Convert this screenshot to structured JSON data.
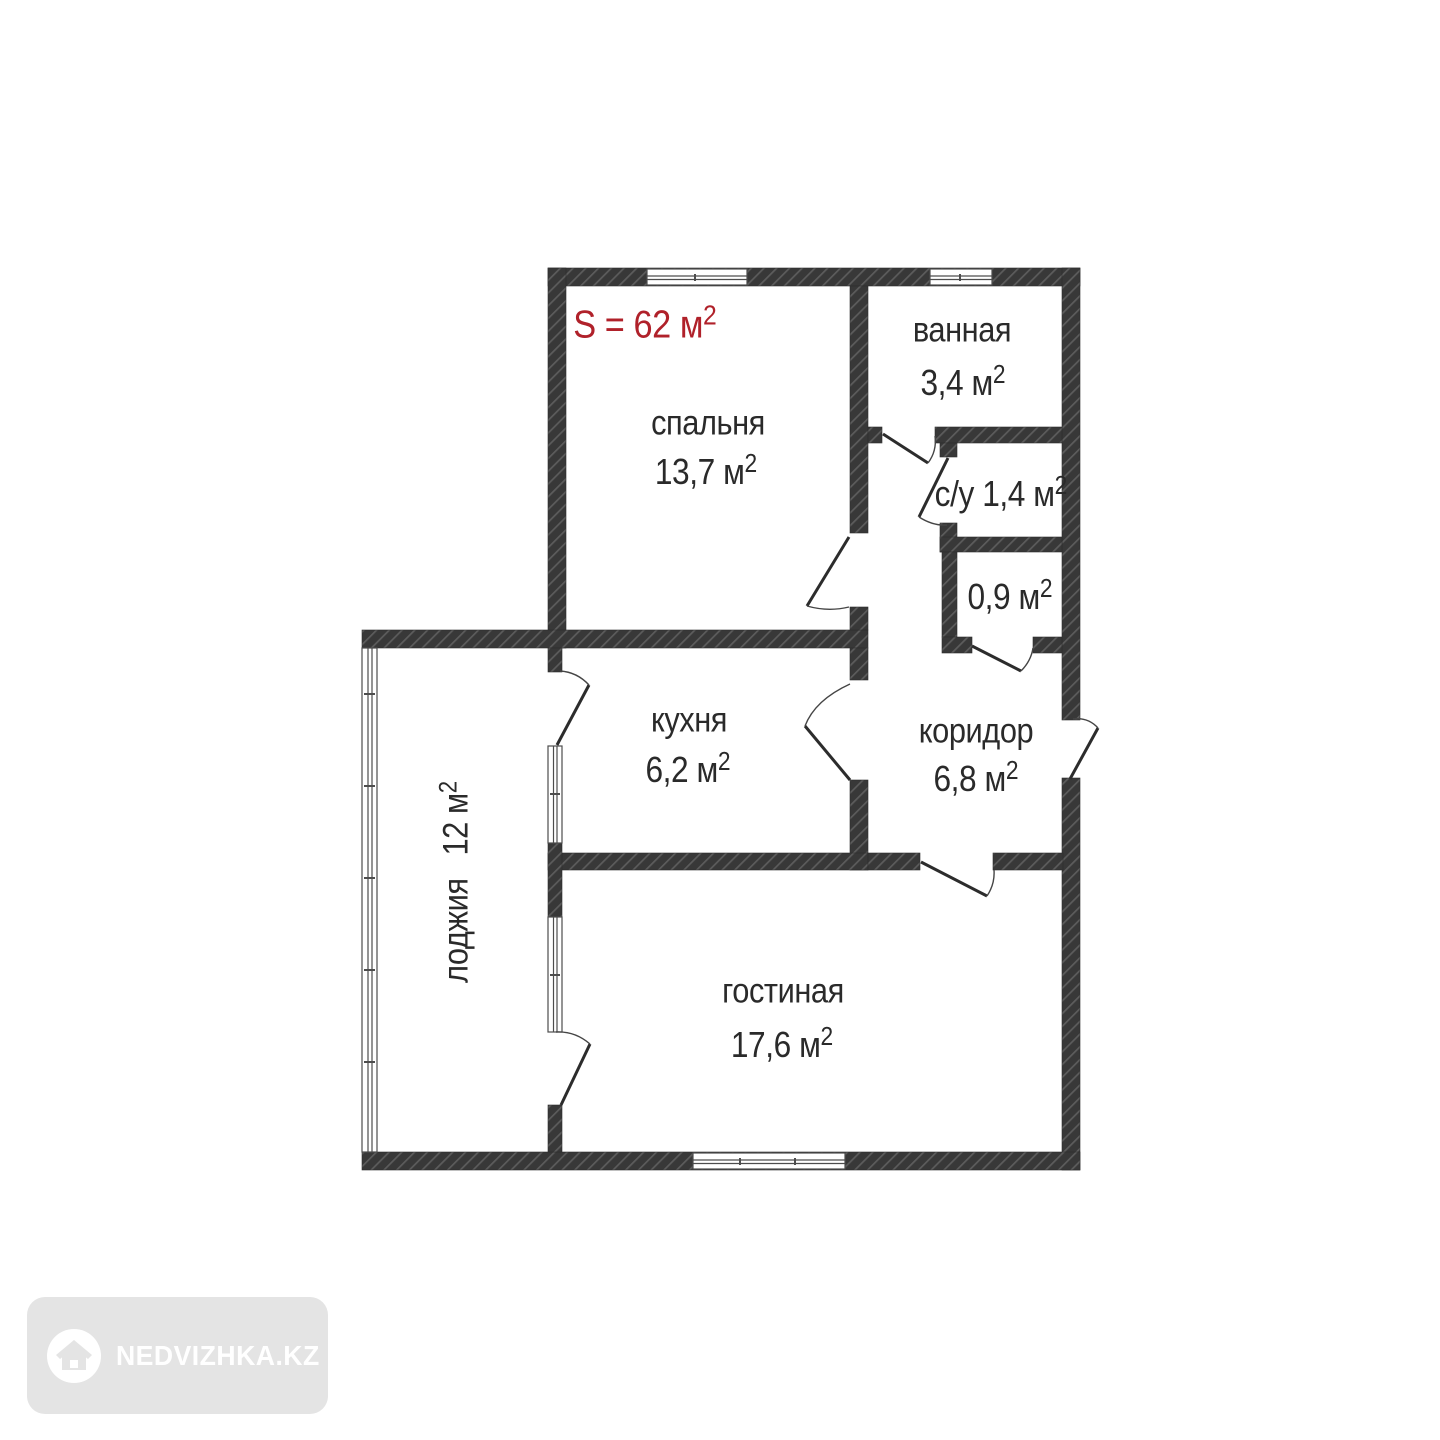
{
  "plan": {
    "total_area": "S = 62 м",
    "sup": "2"
  },
  "rooms": {
    "bedroom": {
      "name": "спальня",
      "area": "13,7 м"
    },
    "bathroom": {
      "name": "ванная",
      "area": "3,4 м"
    },
    "wc": {
      "label": "с/у 1,4 м"
    },
    "storage": {
      "area": "0,9 м"
    },
    "kitchen": {
      "name": "кухня",
      "area": "6,2 м"
    },
    "corridor": {
      "name": "коридор",
      "area": "6,8 м"
    },
    "loggia": {
      "name": "лоджия",
      "area": "12 м"
    },
    "living": {
      "name": "гостиная",
      "area": "17,6 м"
    }
  },
  "watermark": {
    "text": "NEDVIZHKA.KZ"
  },
  "colors": {
    "wall": "#383838",
    "hatch_line": "#5c5c5c",
    "accent_red": "#b0212a",
    "text": "#2a2a2a",
    "watermark_bg": "#e4e4e4",
    "watermark_text": "#ffffff"
  }
}
